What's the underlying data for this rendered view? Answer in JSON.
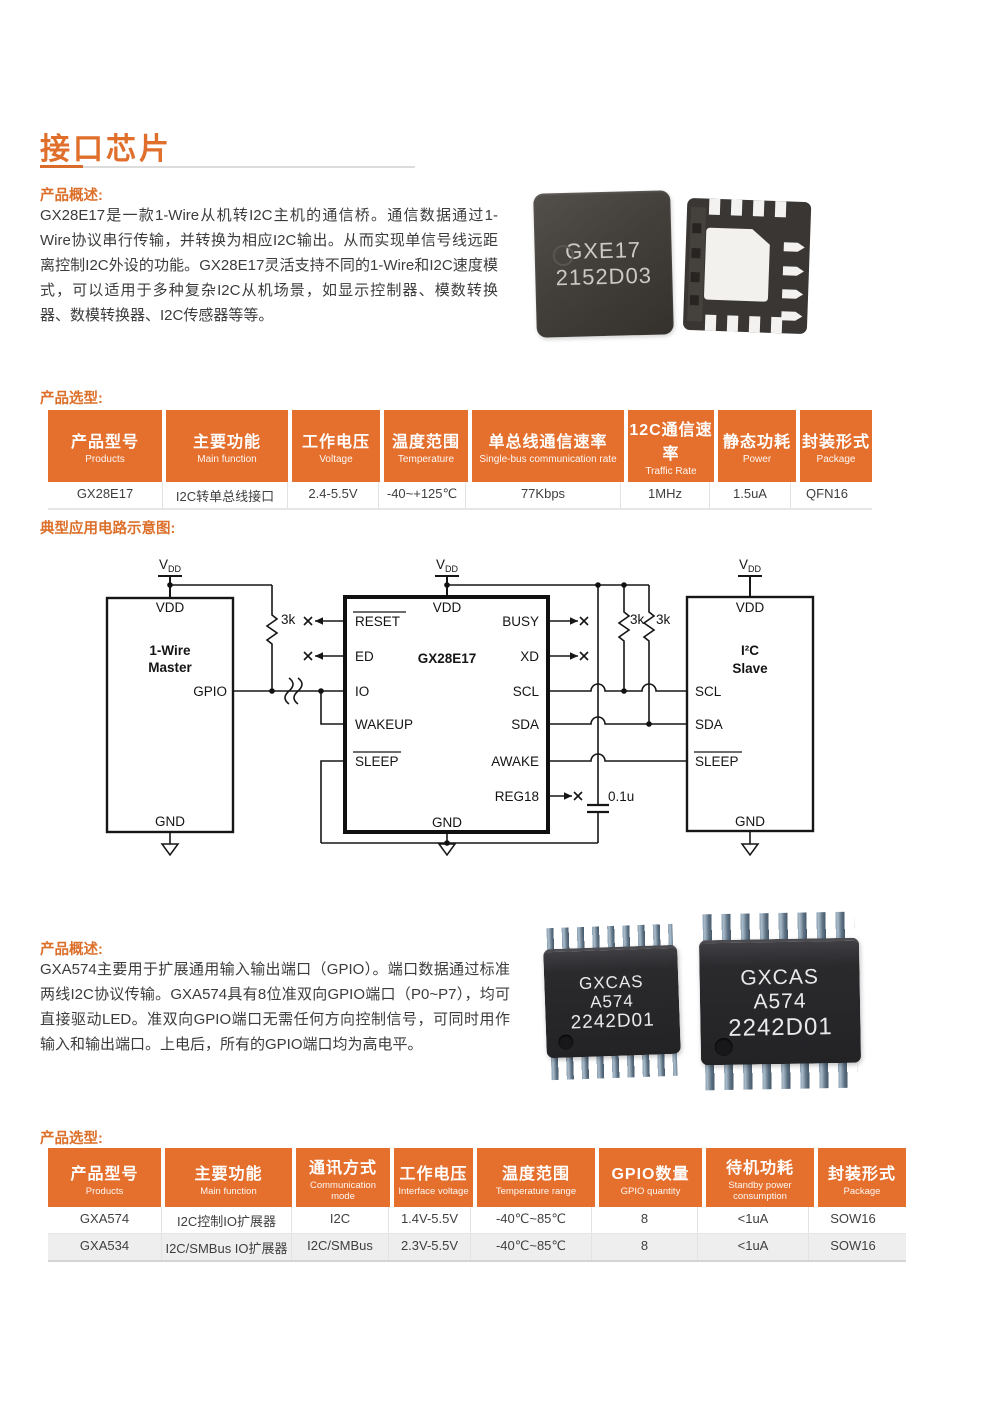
{
  "title": "接口芯片",
  "sec1": {
    "overview_label": "产品概述:",
    "overview_text": "GX28E17是一款1-Wire从机转I2C主机的通信桥。通信数据通过1-Wire协议串行传输，并转换为相应I2C输出。从而实现单信号线远距离控制I2C外设的功能。GX28E17灵活支持不同的1-Wire和I2C速度模式，可以适用于多种复杂I2C从机场景，如显示控制器、模数转换器、数模转换器、I2C传感器等等。",
    "chip_mark_line1": "GXE17",
    "chip_mark_line2": "2152D03",
    "selection_label": "产品选型:",
    "table": {
      "headers": [
        {
          "zh": "产品型号",
          "en": "Products"
        },
        {
          "zh": "主要功能",
          "en": "Main function"
        },
        {
          "zh": "工作电压",
          "en": "Voltage"
        },
        {
          "zh": "温度范围",
          "en": "Temperature"
        },
        {
          "zh": "单总线通信速率",
          "en": "Single-bus communication rate"
        },
        {
          "zh": "12C通信速率",
          "en": "Traffic Rate"
        },
        {
          "zh": "静态功耗",
          "en": "Power"
        },
        {
          "zh": "封装形式",
          "en": "Package"
        }
      ],
      "rows": [
        [
          "GX28E17",
          "I2C转单总线接口",
          "2.4-5.5V",
          "-40~+125℃",
          "77Kbps",
          "1MHz",
          "1.5uA",
          "QFN16"
        ]
      ]
    }
  },
  "circuit": {
    "label": "典型应用电路示意图:",
    "vdd_v": "V",
    "vdd_sub": "DD",
    "master": {
      "pin_top": "VDD",
      "line1": "1-Wire",
      "line2": "Master",
      "pin_gpio": "GPIO",
      "pin_gnd": "GND"
    },
    "bridge": {
      "name": "GX28E17",
      "pin_top": "VDD",
      "pin_gnd": "GND",
      "left": [
        "RESET",
        "ED",
        "IO",
        "WAKEUP",
        "SLEEP"
      ],
      "right": [
        "BUSY",
        "XD",
        "SCL",
        "SDA",
        "AWAKE",
        "REG18"
      ]
    },
    "slave": {
      "pin_top": "VDD",
      "line1": "I²C",
      "line2": "Slave",
      "pins": [
        "SCL",
        "SDA",
        "SLEEP"
      ],
      "pin_gnd": "GND"
    },
    "r1": "3k",
    "r2": "3k",
    "r3": "3k",
    "cap": "0.1u"
  },
  "sec2": {
    "overview_label": "产品概述:",
    "overview_text": "GXA574主要用于扩展通用输入输出端口（GPIO）。端口数据通过标准两线I2C协议传输。GXA574具有8位准双向GPIO端口（P0~P7），均可直接驱动LED。准双向GPIO端口无需任何方向控制信号，可同时用作输入和输出端口。上电后，所有的GPIO端口均为高电平。",
    "chip_mark": [
      "GXCAS",
      "A574",
      "2242D01"
    ],
    "selection_label": "产品选型:",
    "table": {
      "headers": [
        {
          "zh": "产品型号",
          "en": "Products"
        },
        {
          "zh": "主要功能",
          "en": "Main function"
        },
        {
          "zh": "通讯方式",
          "en": "Communication mode"
        },
        {
          "zh": "工作电压",
          "en": "Interface voltage"
        },
        {
          "zh": "温度范围",
          "en": "Temperature range"
        },
        {
          "zh": "GPIO数量",
          "en": "GPIO quantity"
        },
        {
          "zh": "待机功耗",
          "en": "Standby power consumption"
        },
        {
          "zh": "封装形式",
          "en": "Package"
        }
      ],
      "rows": [
        [
          "GXA574",
          "I2C控制IO扩展器",
          "I2C",
          "1.4V-5.5V",
          "-40℃~85℃",
          "8",
          "<1uA",
          "SOW16"
        ],
        [
          "GXA534",
          "I2C/SMBus IO扩展器",
          "I2C/SMBus",
          "2.3V-5.5V",
          "-40℃~85℃",
          "8",
          "<1uA",
          "SOW16"
        ]
      ]
    }
  },
  "colors": {
    "accent": "#e56f2c"
  }
}
